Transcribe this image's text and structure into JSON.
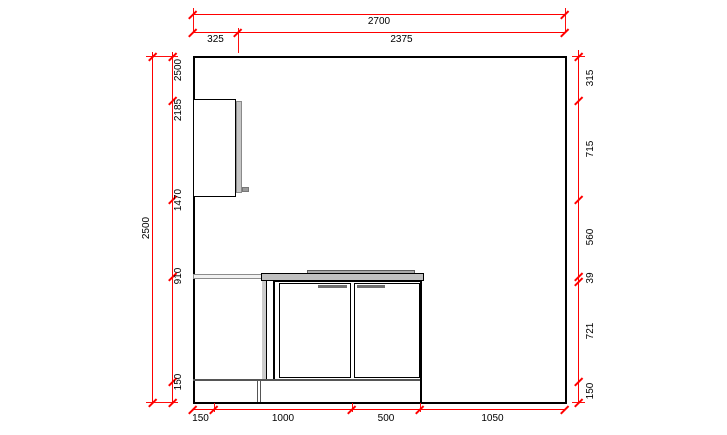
{
  "drawing": {
    "title": "kitchen-wall-elevation",
    "colors": {
      "dimension_lines": "#ff0000",
      "outline": "#000000",
      "countertop_gray": "#c0c0c0",
      "panel_gray": "#cccccc"
    },
    "dims": {
      "top_overall": "2700",
      "top_segments": [
        "325",
        "2375"
      ],
      "left_overall": "2500",
      "left_running": [
        "2500",
        "2185",
        "1470",
        "910",
        "150"
      ],
      "right_segments": [
        "315",
        "715",
        "560",
        "39",
        "721",
        "150"
      ],
      "bottom_segments": [
        "150",
        "1000",
        "500",
        "1050"
      ]
    }
  }
}
